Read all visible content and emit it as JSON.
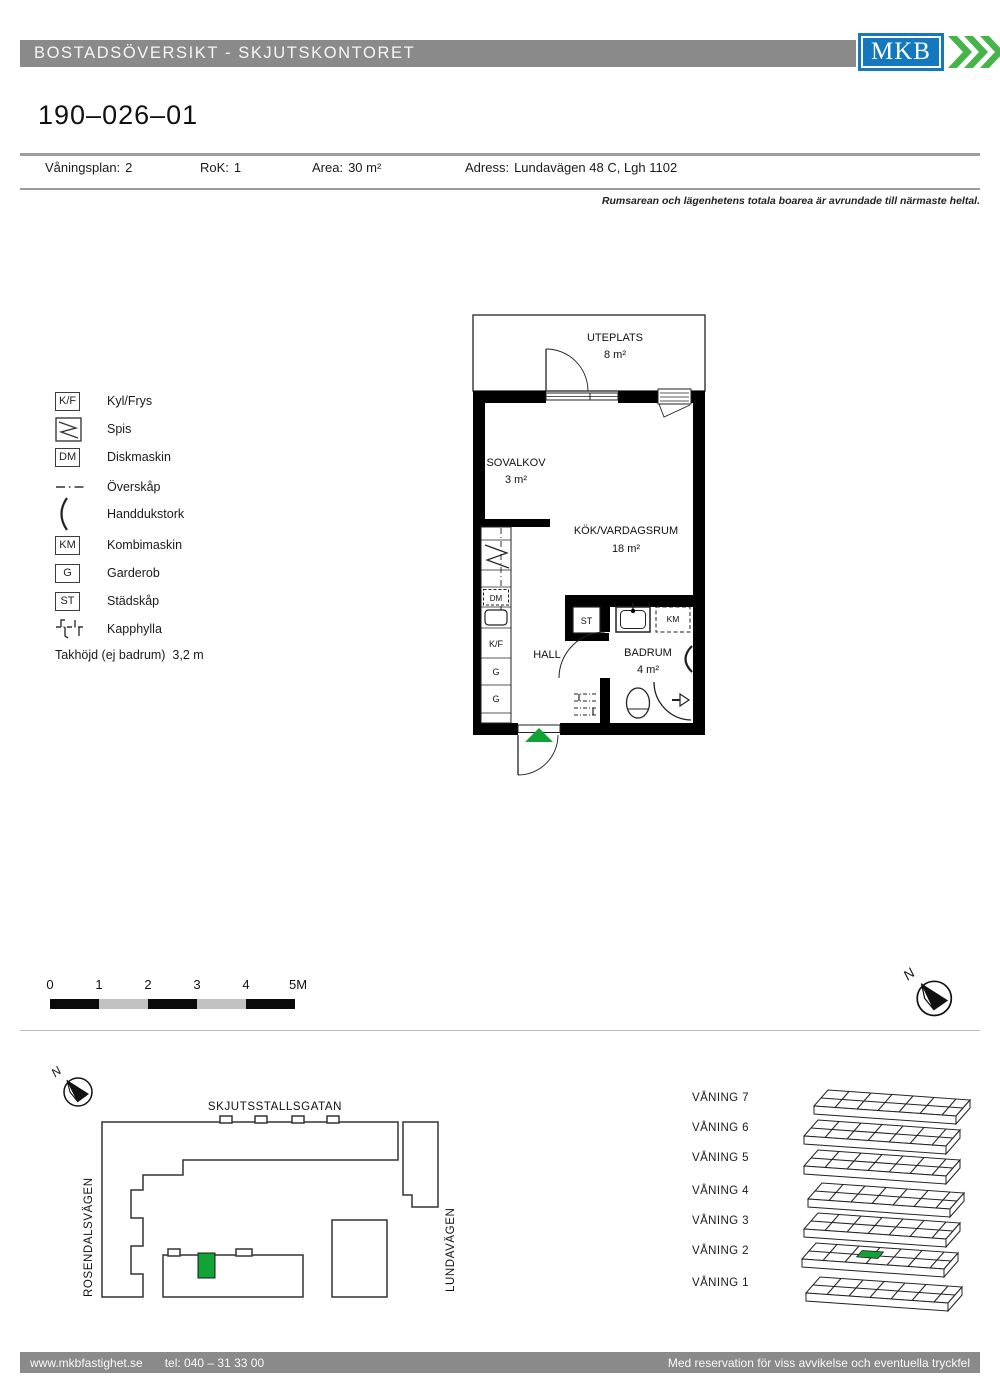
{
  "header": {
    "title": "BOSTADSÖVERSIKT - SKJUTSKONTORET",
    "logo_text": "MKB"
  },
  "apartment": {
    "id": "190–026–01"
  },
  "info": {
    "floor_label": "Våningsplan:",
    "floor_value": "2",
    "rok_label": "RoK:",
    "rok_value": "1",
    "area_label": "Area:",
    "area_value": "30 m²",
    "address_label": "Adress:",
    "address_value": "Lundavägen 48 C, Lgh 1102"
  },
  "note": "Rumsarean och lägenhetens totala boarea är avrundade till närmaste heltal.",
  "legend": {
    "items": [
      {
        "symbol": "K/F",
        "label": "Kyl/Frys"
      },
      {
        "symbol": "",
        "label": "Spis"
      },
      {
        "symbol": "DM",
        "label": "Diskmaskin"
      },
      {
        "symbol": "",
        "label": "Överskåp"
      },
      {
        "symbol": "",
        "label": "Handdukstork"
      },
      {
        "symbol": "KM",
        "label": "Kombimaskin"
      },
      {
        "symbol": "G",
        "label": "Garderob"
      },
      {
        "symbol": "ST",
        "label": "Städskåp"
      },
      {
        "symbol": "",
        "label": "Kapphylla"
      }
    ],
    "ceiling_note": "Takhöjd (ej badrum)  3,2 m"
  },
  "plan": {
    "rooms": {
      "uteplats": {
        "name": "UTEPLATS",
        "area": "8 m²"
      },
      "sovalkov": {
        "name": "SOVALKOV",
        "area": "3 m²"
      },
      "kok": {
        "name": "KÖK/VARDAGSRUM",
        "area": "18 m²"
      },
      "hall": {
        "name": "HALL"
      },
      "badrum": {
        "name": "BADRUM",
        "area": "4 m²"
      }
    },
    "fixtures": {
      "dm": "DM",
      "kf": "K/F",
      "g1": "G",
      "g2": "G",
      "st": "ST",
      "km": "KM"
    }
  },
  "scalebar": {
    "labels": [
      "0",
      "1",
      "2",
      "3",
      "4",
      "5M"
    ]
  },
  "compass": {
    "north_label": "N"
  },
  "sitemap": {
    "streets": {
      "top": "SKJUTSSTALLSGATAN",
      "left": "ROSENDALSVÄGEN",
      "right": "LUNDAVÄGEN"
    }
  },
  "floors": {
    "items": [
      "VÅNING 7",
      "VÅNING 6",
      "VÅNING 5",
      "VÅNING 4",
      "VÅNING 3",
      "VÅNING 2",
      "VÅNING 1"
    ],
    "highlighted": "VÅNING 2"
  },
  "footer": {
    "website": "www.mkbfastighet.se",
    "phone": "tel: 040 – 31 33 00",
    "right": "Med reservation för viss avvikelse och eventuella tryckfel"
  },
  "colors": {
    "header_gray": "#8a8a8a",
    "logo_blue": "#1478be",
    "logo_green": "#45b549",
    "marker_green": "#12a337",
    "divider_gray": "#9c9c9c"
  }
}
